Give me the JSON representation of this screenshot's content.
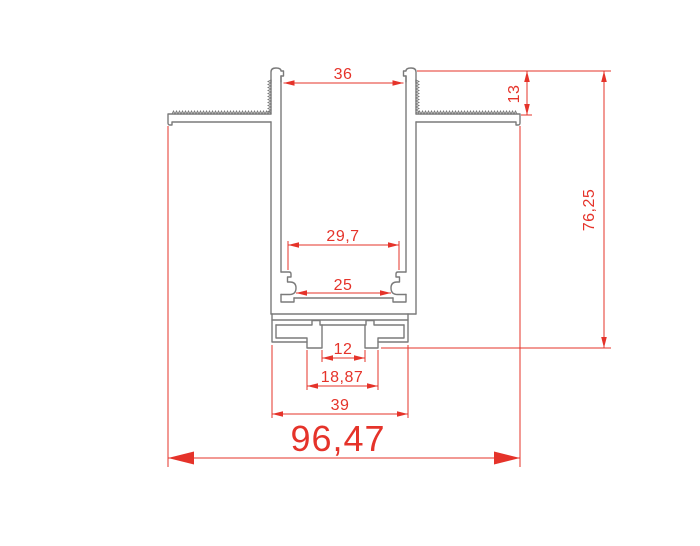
{
  "drawing": {
    "kind": "technical cross-section of recessed aluminium profile",
    "dimensions": {
      "top_opening": "36",
      "flange_height": "13",
      "total_height": "76,25",
      "upper_inner_width": "29,7",
      "clip_span": "25",
      "slot_width": "12",
      "stem_width": "18,87",
      "base_width": "39",
      "total_width": "96,47"
    },
    "colors": {
      "dimension_red": "#e5332a",
      "profile_gray": "#7a7a7a",
      "background": "#ffffff"
    }
  }
}
